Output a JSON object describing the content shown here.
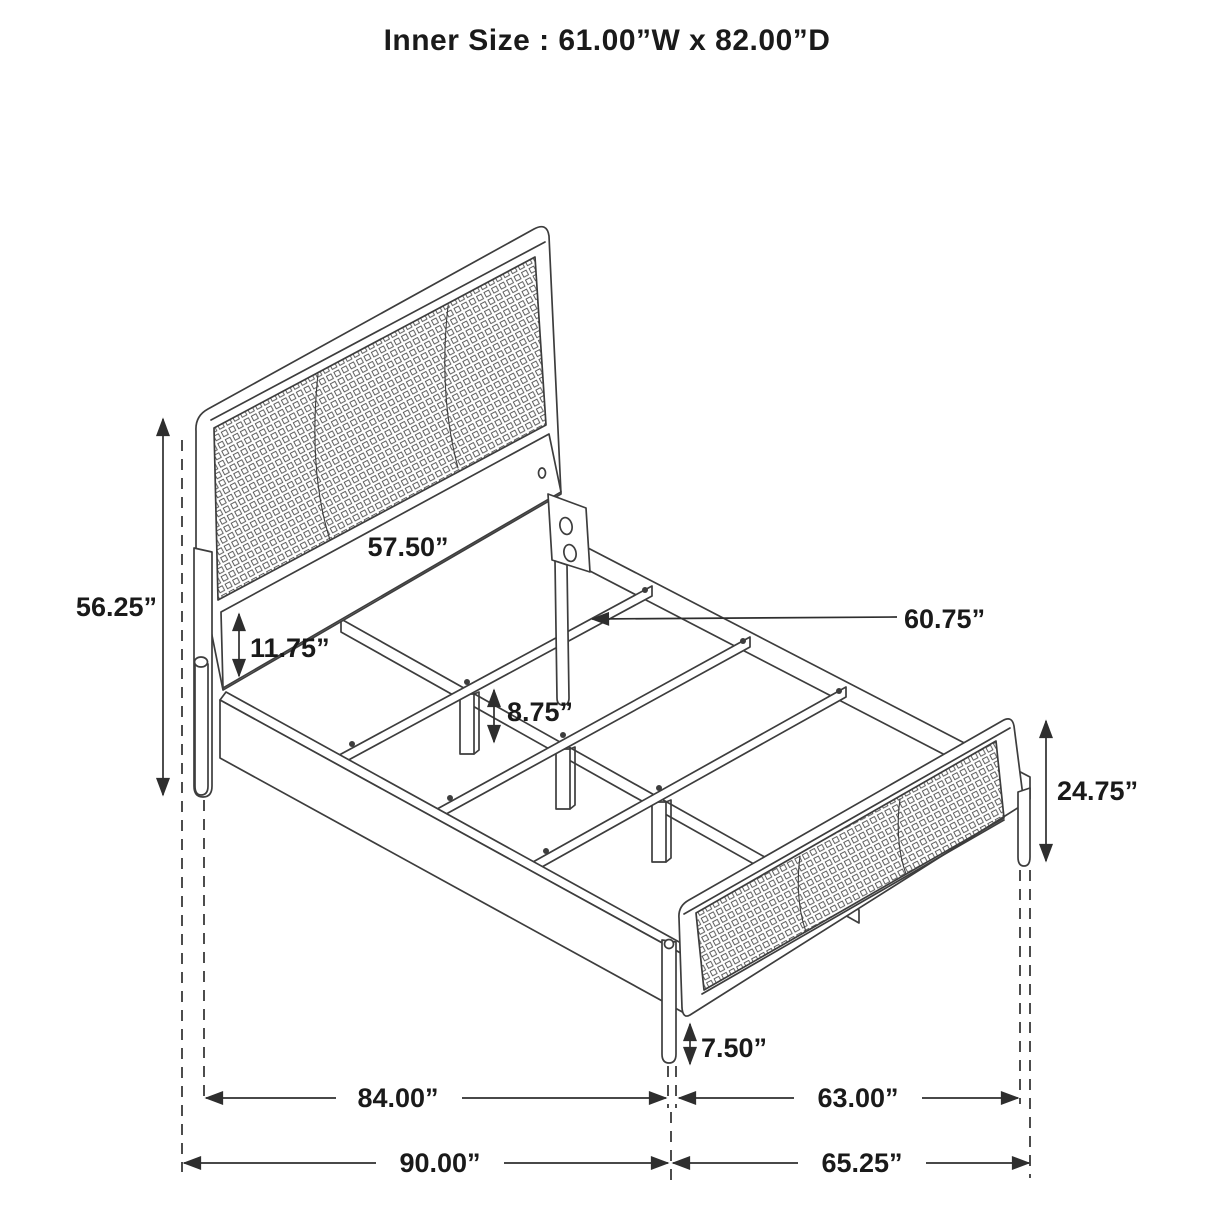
{
  "title": "Inner Size : 61.00”W x 82.00”D",
  "dimensions": {
    "headboard_height": "56.25”",
    "headboard_rail_width": "57.50”",
    "side_rail_height": "11.75”",
    "slat_leg_height": "8.75”",
    "slat_length": "60.75”",
    "footboard_height": "24.75”",
    "footboard_leg_height": "7.50”",
    "frame_inner_length": "84.00”",
    "footboard_inner_width": "63.00”",
    "overall_length": "90.00”",
    "overall_width": "65.25”"
  },
  "colors": {
    "line": "#3d3d3d",
    "dimension_line": "#2e2e2e",
    "text": "#1a1a1a",
    "background": "#ffffff"
  }
}
